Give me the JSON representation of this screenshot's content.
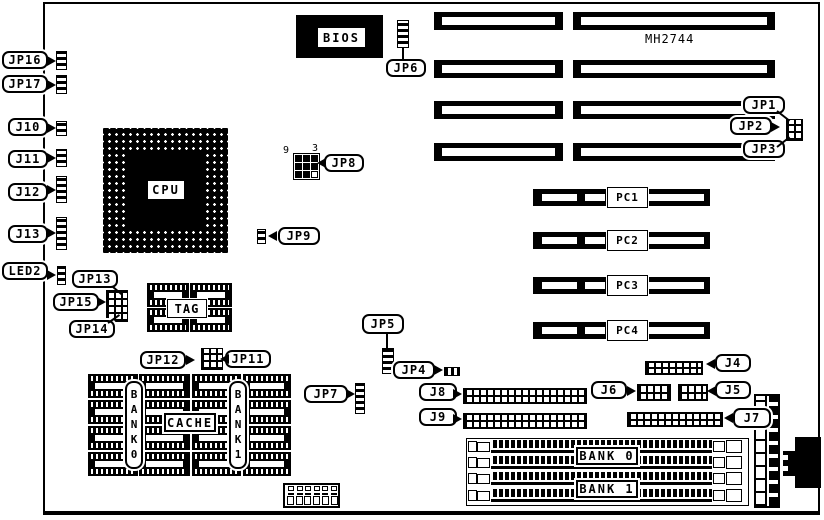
{
  "board": {
    "model": "MH2744"
  },
  "chips": {
    "bios": "BIOS",
    "cpu": "CPU",
    "tag": "TAG",
    "cache": "CACHE",
    "cache_bank_left": "BANK0",
    "cache_bank_right": "BANK1"
  },
  "jumpers": {
    "jp1": "JP1",
    "jp2": "JP2",
    "jp3": "JP3",
    "jp4": "JP4",
    "jp5": "JP5",
    "jp6": "JP6",
    "jp7": "JP7",
    "jp8": "JP8",
    "jp9": "JP9",
    "jp11": "JP11",
    "jp12": "JP12",
    "jp13": "JP13",
    "jp14": "JP14",
    "jp15": "JP15",
    "jp16": "JP16",
    "jp17": "JP17"
  },
  "connectors": {
    "j4": "J4",
    "j5": "J5",
    "j6": "J6",
    "j7": "J7",
    "j8": "J8",
    "j9": "J9",
    "j10": "J10",
    "j11": "J11",
    "j12": "J12",
    "j13": "J13",
    "led2": "LED2"
  },
  "jp8_pin_numbers": {
    "corner_left": "9",
    "corner_right": "3"
  },
  "expansion_slots": {
    "isa_slot_count": 8,
    "pci": [
      {
        "label": "PC1"
      },
      {
        "label": "PC2"
      },
      {
        "label": "PC3"
      },
      {
        "label": "PC4"
      }
    ]
  },
  "memory": {
    "simm_socket_rows": 4,
    "simm_banks": [
      {
        "label": "BANK 0"
      },
      {
        "label": "BANK 1"
      }
    ]
  },
  "colors": {
    "ink": "#000000",
    "paper": "#ffffff"
  }
}
